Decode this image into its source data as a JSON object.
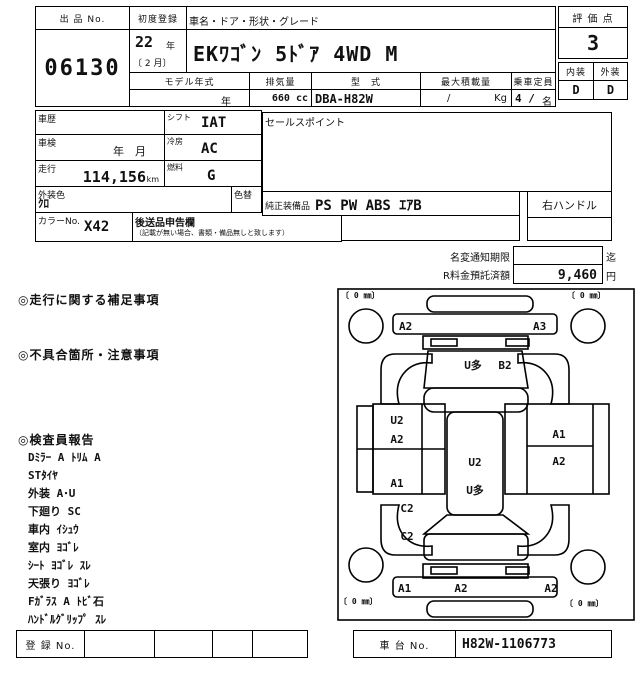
{
  "header": {
    "lot_label": "出 品 No.",
    "lot_no": "06130",
    "first_reg_label": "初度登録",
    "first_reg_year_num": "22",
    "first_reg_year_unit": "年",
    "first_reg_month": "〔 2 月〕",
    "name_label": "車名・ドア・形状・グレード",
    "car_name": "EKﾜｺﾞﾝ 5ﾄﾞｱ 4WD M",
    "model_year_label": "モデル年式",
    "model_year_value": "年",
    "displacement_label": "排気量",
    "displacement_value": "660 cc",
    "model_code_label": "型　式",
    "model_code_value": "DBA-H82W",
    "payload_label": "最大積載量",
    "payload_slash": "/",
    "payload_unit": "Kg",
    "capacity_value": "4 /",
    "capacity_label": "乗車定員",
    "capacity_unit": "名",
    "grade_label": "評 価 点",
    "grade_value": "3",
    "interior_label": "内装",
    "exterior_label": "外装",
    "interior_grade": "D",
    "exterior_grade": "D"
  },
  "details": {
    "history_label": "車歴",
    "shift_label": "シフト",
    "shift_value": "IAT",
    "inspection_label": "車検",
    "inspection_value": "年　月",
    "aircon_label": "冷房",
    "aircon_value": "AC",
    "mileage_label": "走行",
    "mileage_value": "114,156",
    "mileage_unit": "km",
    "fuel_label": "燃料",
    "fuel_value": "G",
    "color_label": "外装色",
    "color_value": "ｸﾛ",
    "repaint_label": "色替",
    "color_no_label": "カラーNo.",
    "color_no_value": "X42",
    "late_items_label": "後送品申告欄",
    "late_items_note": "（記載が無い場合、書類・備品無しと致します）",
    "sales_point_label": "セールスポイント",
    "equipment_label": "純正装備品",
    "equipment_value": "PS PW ABS ｴｱB",
    "handle_value": "右ハンドル"
  },
  "notices": {
    "name_change_label": "名変通知期限",
    "name_change_suffix": "迄",
    "recycle_label": "R料金預託済額",
    "recycle_value": "9,460",
    "recycle_unit": "円"
  },
  "remarks": {
    "running_title": "◎走行に関する補足事項",
    "defect_title": "◎不具合箇所・注意事項",
    "inspector_title": "◎検査員報告",
    "inspector_items": [
      "Dﾐﾗｰ A  ﾄﾘﾑ A",
      "STﾀｲﾔ",
      "外装 A･U",
      "下廻り SC",
      "車内 ｲｼｭｳ",
      "室内 ﾖｺﾞﾚ",
      "ｼｰﾄ ﾖｺﾞﾚ ｽﾚ",
      "天張り ﾖｺﾞﾚ",
      "Fｶﾞﾗｽ A ﾄﾋﾞ石",
      "ﾊﾝﾄﾞﾙｸﾞﾘｯﾌﾟ ｽﾚ"
    ]
  },
  "diagram": {
    "tire_mark": "〔 0 ㎜〕",
    "front_strip_left": "A2",
    "front_strip_right": "A3",
    "windshield_left": "U多",
    "windshield_right": "B2",
    "left_panel_top1": "U2",
    "left_panel_top2": "A2",
    "left_panel_bottom": "A1",
    "roof_top": "U2",
    "roof_bottom": "U多",
    "right_panel_top": "A1",
    "right_panel_bottom": "A2",
    "rear_quarter_top": "C2",
    "rear_quarter_bottom": "C2",
    "rear_strip_left": "A1",
    "rear_strip_mid": "A2",
    "rear_strip_right": "A2"
  },
  "footer": {
    "reg_no_label": "登 録 No.",
    "chassis_no_label": "車 台 No.",
    "chassis_no_value": "H82W-1106773"
  }
}
